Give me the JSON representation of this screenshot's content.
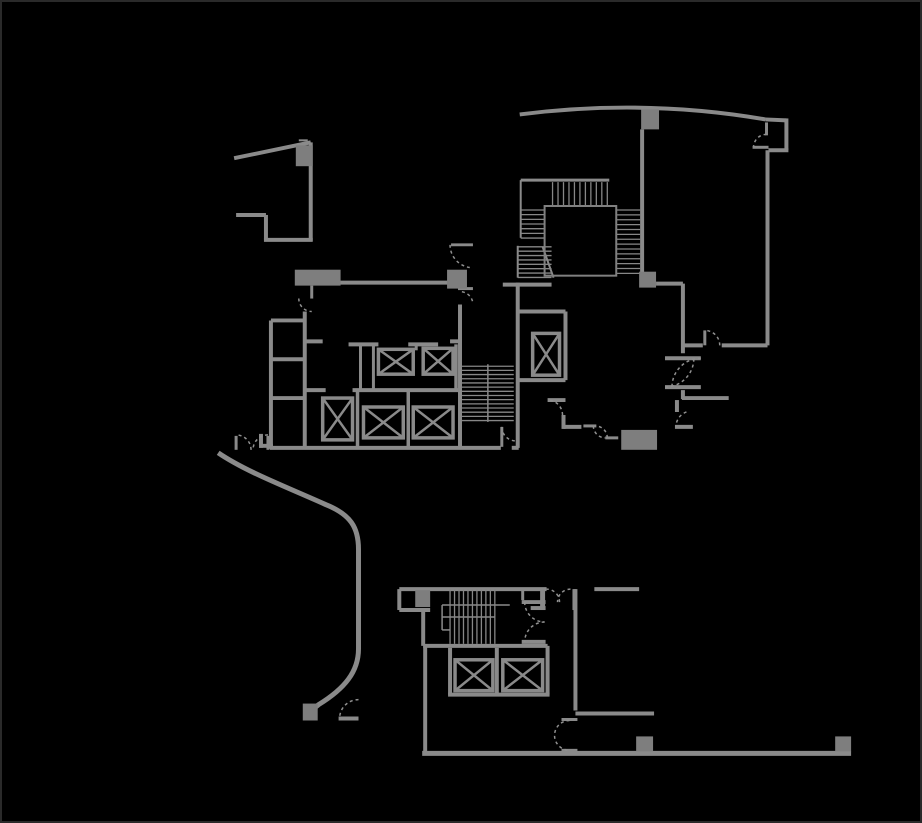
{
  "canvas": {
    "width": 922,
    "height": 823,
    "background": "#000000",
    "border_color": "#2a2a2a"
  },
  "plan": {
    "colors": {
      "wall": "#8a8a8a",
      "column": "#7e7e7e",
      "hatch": "#878787",
      "arc": "#909090",
      "car": "#8a8a8a",
      "thin": "#808080"
    },
    "walls": [
      [
        233,
        157,
        310,
        141,
        4
      ],
      [
        310,
        141,
        310,
        240,
        4
      ],
      [
        235,
        214,
        265,
        214,
        4
      ],
      [
        265,
        214,
        265,
        239,
        4
      ],
      [
        263,
        239,
        312,
        239,
        4
      ],
      [
        298,
        139,
        307,
        139,
        2
      ],
      [
        767,
        118,
        788,
        119,
        4
      ],
      [
        788,
        117,
        788,
        149,
        4
      ],
      [
        770,
        149,
        790,
        149,
        4
      ],
      [
        754,
        146,
        770,
        146,
        3
      ],
      [
        769,
        149,
        769,
        345,
        4
      ],
      [
        723,
        345,
        769,
        345,
        4
      ],
      [
        685,
        345,
        704,
        345,
        4
      ],
      [
        684,
        283,
        684,
        353,
        4
      ],
      [
        657,
        283,
        684,
        283,
        4
      ],
      [
        666,
        358,
        702,
        358,
        4
      ],
      [
        666,
        387,
        702,
        387,
        4
      ],
      [
        684,
        390,
        684,
        399,
        4
      ],
      [
        683,
        398,
        730,
        398,
        4
      ],
      [
        678,
        400,
        678,
        412,
        4
      ],
      [
        676,
        427,
        694,
        427,
        4
      ],
      [
        643,
        128,
        643,
        272,
        4
      ],
      [
        521,
        179,
        610,
        179,
        3
      ],
      [
        521,
        179,
        521,
        237,
        2
      ],
      [
        518,
        245,
        518,
        277,
        2
      ],
      [
        543,
        246,
        554,
        277,
        2
      ],
      [
        312,
        282,
        464,
        282,
        4
      ],
      [
        503,
        284,
        552,
        284,
        4
      ],
      [
        451,
        244,
        473,
        244,
        3
      ],
      [
        458,
        288,
        473,
        288,
        3
      ],
      [
        304,
        311,
        304,
        449,
        4
      ],
      [
        270,
        320,
        270,
        449,
        4
      ],
      [
        270,
        320,
        304,
        320,
        4
      ],
      [
        270,
        359,
        304,
        359,
        4
      ],
      [
        270,
        398,
        304,
        398,
        4
      ],
      [
        260,
        434,
        260,
        448,
        4
      ],
      [
        258,
        446,
        272,
        446,
        4
      ],
      [
        269,
        448,
        501,
        448,
        4
      ],
      [
        512,
        448,
        519,
        448,
        4
      ],
      [
        305,
        341,
        322,
        341,
        4
      ],
      [
        450,
        341,
        462,
        341,
        4
      ],
      [
        348,
        344,
        378,
        344,
        4
      ],
      [
        408,
        344,
        438,
        344,
        4
      ],
      [
        360,
        344,
        360,
        390,
        3
      ],
      [
        373,
        344,
        373,
        390,
        3
      ],
      [
        416,
        344,
        416,
        350,
        3
      ],
      [
        352,
        390,
        458,
        390,
        4
      ],
      [
        305,
        390,
        325,
        390,
        4
      ],
      [
        357,
        390,
        357,
        448,
        3.5
      ],
      [
        408,
        390,
        408,
        448,
        3.5
      ],
      [
        456,
        344,
        456,
        390,
        3.5
      ],
      [
        460,
        304,
        460,
        449,
        4
      ],
      [
        518,
        282,
        518,
        448,
        4
      ],
      [
        518,
        311,
        566,
        311,
        4
      ],
      [
        566,
        311,
        566,
        380,
        4
      ],
      [
        518,
        380,
        566,
        380,
        4
      ],
      [
        548,
        400,
        566,
        400,
        4
      ],
      [
        564,
        415,
        564,
        429,
        4
      ],
      [
        564,
        427,
        582,
        427,
        4
      ],
      [
        584,
        426,
        597,
        426,
        3
      ],
      [
        606,
        438,
        619,
        438,
        3
      ],
      [
        399,
        590,
        547,
        590,
        4
      ],
      [
        399,
        590,
        399,
        611,
        4
      ],
      [
        399,
        611,
        430,
        611,
        4
      ],
      [
        423,
        611,
        423,
        647,
        4
      ],
      [
        543,
        590,
        543,
        609,
        5
      ],
      [
        531,
        609,
        546,
        609,
        4
      ],
      [
        522,
        603,
        546,
        603,
        4
      ],
      [
        522,
        643,
        546,
        643,
        4
      ],
      [
        575,
        590,
        575,
        611,
        4
      ],
      [
        595,
        590,
        640,
        590,
        4
      ],
      [
        576,
        590,
        576,
        712,
        4
      ],
      [
        576,
        715,
        655,
        715,
        4
      ],
      [
        562,
        721,
        578,
        721,
        3
      ],
      [
        562,
        752,
        578,
        752,
        3
      ],
      [
        423,
        647,
        548,
        647,
        4
      ],
      [
        450,
        649,
        450,
        696,
        4
      ],
      [
        497,
        649,
        497,
        696,
        4
      ],
      [
        548,
        647,
        548,
        696,
        4
      ],
      [
        448,
        696,
        550,
        696,
        4
      ],
      [
        425,
        647,
        425,
        755,
        4
      ],
      [
        422,
        755,
        853,
        755,
        5
      ],
      [
        338,
        720,
        358,
        720,
        4
      ],
      [
        442,
        606,
        510,
        606,
        1.5
      ],
      [
        442,
        618,
        495,
        618,
        1.5
      ],
      [
        442,
        606,
        442,
        631,
        1.5
      ],
      [
        442,
        631,
        450,
        631,
        1.5
      ],
      [
        488,
        364,
        488,
        422,
        1.5
      ]
    ],
    "door_leaves": [
      [
        768,
        121,
        768,
        134,
        3
      ],
      [
        706,
        330,
        706,
        345,
        3
      ],
      [
        311,
        285,
        311,
        298,
        3
      ],
      [
        502,
        427,
        502,
        447,
        3
      ],
      [
        235,
        436,
        235,
        450,
        3
      ],
      [
        267,
        436,
        267,
        450,
        3
      ],
      [
        523,
        590,
        523,
        601,
        3
      ]
    ],
    "columns": [
      [
        295,
        144,
        17,
        21
      ],
      [
        294,
        269,
        46,
        16
      ],
      [
        447,
        269,
        20,
        19
      ],
      [
        642,
        108,
        18,
        20
      ],
      [
        640,
        271,
        17,
        16
      ],
      [
        622,
        430,
        36,
        20
      ],
      [
        415,
        591,
        15,
        17
      ],
      [
        302,
        705,
        15,
        17
      ],
      [
        637,
        738,
        17,
        15
      ],
      [
        837,
        738,
        16,
        15
      ]
    ],
    "elevator_cars": [
      [
        378,
        349,
        35,
        25
      ],
      [
        423,
        348,
        30,
        26
      ],
      [
        322,
        398,
        30,
        42
      ],
      [
        363,
        407,
        40,
        31
      ],
      [
        413,
        407,
        40,
        31
      ],
      [
        533,
        333,
        27,
        42
      ],
      [
        455,
        661,
        38,
        31
      ],
      [
        503,
        661,
        40,
        31
      ]
    ],
    "shaft_outlines": [
      [
        545,
        205,
        72,
        70
      ]
    ],
    "hatches": [
      {
        "dir": "v",
        "x": 553,
        "y": 181,
        "len": 23,
        "count": 11,
        "gap": 5.5,
        "w": 1.3
      },
      {
        "dir": "h",
        "x": 521,
        "y": 209,
        "len": 24,
        "count": 7,
        "gap": 4.7,
        "w": 1.3
      },
      {
        "dir": "h",
        "x": 518,
        "y": 246,
        "len": 34,
        "count": 8,
        "gap": 4.4,
        "w": 1.3
      },
      {
        "dir": "h",
        "x": 617,
        "y": 209,
        "len": 24,
        "count": 14,
        "gap": 4.9,
        "w": 1.3
      },
      {
        "dir": "h",
        "x": 462,
        "y": 366,
        "len": 52,
        "count": 14,
        "gap": 4.2,
        "w": 1.3
      },
      {
        "dir": "v",
        "x": 450,
        "y": 590,
        "len": 55,
        "count": 11,
        "gap": 4.5,
        "w": 1.3
      }
    ],
    "door_arcs": [
      {
        "cx": 768,
        "cy": 146,
        "r": 13,
        "a1": 90,
        "a2": 180
      },
      {
        "cx": 706,
        "cy": 345,
        "r": 15,
        "a1": 0,
        "a2": 90
      },
      {
        "cx": 666,
        "cy": 358,
        "r": 29,
        "a1": 270,
        "a2": 360
      },
      {
        "cx": 702,
        "cy": 387,
        "r": 29,
        "a1": 90,
        "a2": 180
      },
      {
        "cx": 693,
        "cy": 427,
        "r": 16,
        "a1": 110,
        "a2": 180
      },
      {
        "cx": 473,
        "cy": 244,
        "r": 23,
        "a1": 180,
        "a2": 262
      },
      {
        "cx": 460,
        "cy": 304,
        "r": 13,
        "a1": 15,
        "a2": 90
      },
      {
        "cx": 311,
        "cy": 298,
        "r": 13,
        "a1": 180,
        "a2": 270
      },
      {
        "cx": 516,
        "cy": 427,
        "r": 14,
        "a1": 180,
        "a2": 270
      },
      {
        "cx": 235,
        "cy": 450,
        "r": 15,
        "a1": 0,
        "a2": 90
      },
      {
        "cx": 267,
        "cy": 450,
        "r": 15,
        "a1": 90,
        "a2": 180
      },
      {
        "cx": 548,
        "cy": 415,
        "r": 15,
        "a1": 0,
        "a2": 90
      },
      {
        "cx": 596,
        "cy": 438,
        "r": 12,
        "a1": 0,
        "a2": 90
      },
      {
        "cx": 606,
        "cy": 426,
        "r": 12,
        "a1": 180,
        "a2": 270
      },
      {
        "cx": 545,
        "cy": 603,
        "r": 20,
        "a1": 180,
        "a2": 270
      },
      {
        "cx": 545,
        "cy": 643,
        "r": 20,
        "a1": 90,
        "a2": 180
      },
      {
        "cx": 547,
        "cy": 603,
        "r": 13,
        "a1": 0,
        "a2": 90
      },
      {
        "cx": 571,
        "cy": 603,
        "r": 13,
        "a1": 90,
        "a2": 180
      },
      {
        "cx": 570,
        "cy": 737,
        "r": 15,
        "a1": 90,
        "a2": 270
      },
      {
        "cx": 358,
        "cy": 720,
        "r": 19,
        "a1": 90,
        "a2": 180
      }
    ],
    "curves": [
      {
        "d": "M 520 113 Q 645 97 767 118",
        "w": 4
      },
      {
        "d": "M 217 453 C 245 472 285 487 325 505 C 350 515 358 528 358 550 L 358 650 C 358 673 344 690 318 706 L 313 710",
        "w": 5
      }
    ]
  }
}
